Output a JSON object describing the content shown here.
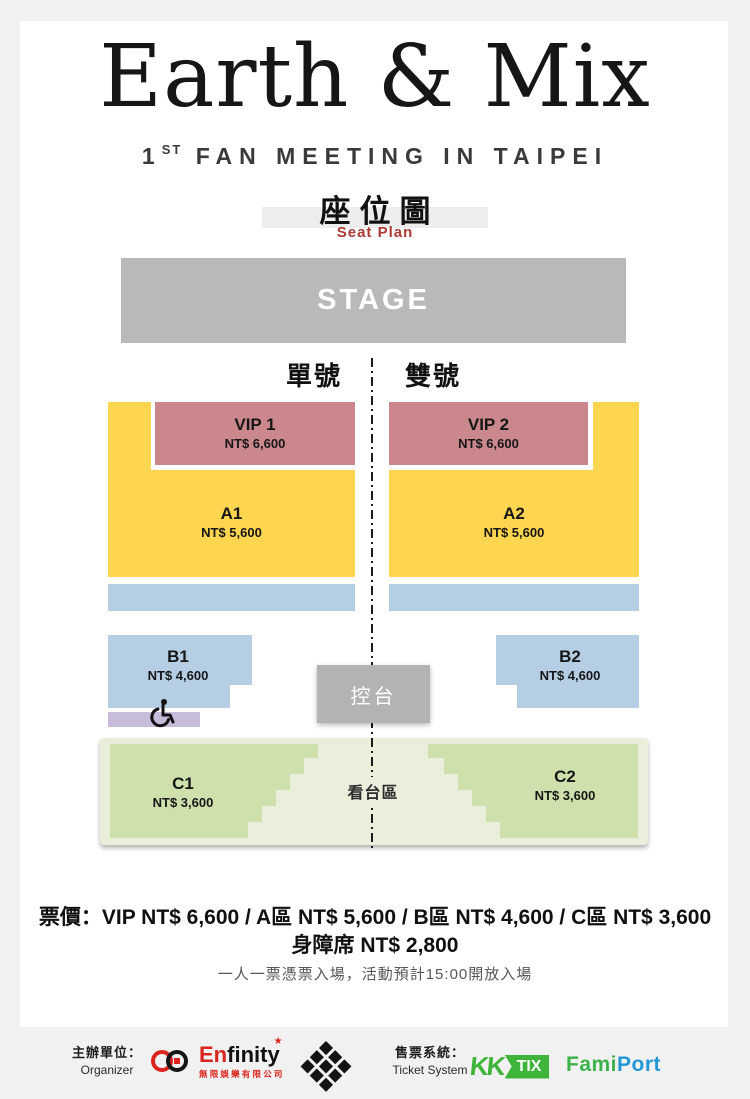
{
  "header": {
    "title": "Earth & Mix",
    "subtitle_number": "1",
    "subtitle_ordinal": "ST",
    "subtitle_text": "FAN MEETING IN TAIPEI",
    "seat_plan_zh": "座位圖",
    "seat_plan_en": "Seat Plan"
  },
  "seat_map": {
    "stage_label": "STAGE",
    "odd_side_label": "單號",
    "even_side_label": "雙號",
    "control_booth_label": "控台",
    "stand_area_label": "看台區",
    "sections": {
      "vip1": {
        "name": "VIP 1",
        "price": "NT$ 6,600",
        "color": "#ca878c"
      },
      "vip2": {
        "name": "VIP 2",
        "price": "NT$ 6,600",
        "color": "#ca878c"
      },
      "a1": {
        "name": "A1",
        "price": "NT$ 5,600",
        "color": "#fdd54e"
      },
      "a2": {
        "name": "A2",
        "price": "NT$ 5,600",
        "color": "#fdd54e"
      },
      "b1": {
        "name": "B1",
        "price": "NT$ 4,600",
        "color": "#b6cee4"
      },
      "b2": {
        "name": "B2",
        "price": "NT$ 4,600",
        "color": "#b6cee4"
      },
      "c1": {
        "name": "C1",
        "price": "NT$ 3,600",
        "color": "#cfe0ac"
      },
      "c2": {
        "name": "C2",
        "price": "NT$ 3,600",
        "color": "#cfe0ac"
      }
    },
    "accessible_row_color": "#c8bcdb",
    "stage_color": "#b9b9b9",
    "stand_area_color": "#e9efdb"
  },
  "pricing": {
    "summary": "票價：VIP NT$ 6,600 / A區 NT$ 5,600 / B區 NT$ 4,600 / C區 NT$ 3,600",
    "accessible": "身障席 NT$ 2,800",
    "admission_note": "一人一票憑票入場，活動預計15:00開放入場"
  },
  "footer": {
    "organizer_label_zh": "主辦單位：",
    "organizer_label_en": "Organizer",
    "ticket_system_label_zh": "售票系統：",
    "ticket_system_label_en": "Ticket System",
    "enfinity": {
      "name_prefix": "En",
      "name_suffix": "finity",
      "star": "★",
      "company_zh": "無限娛樂有限公司"
    },
    "kktix": {
      "kk": "KK",
      "tix": "TIX"
    },
    "famiport": {
      "green": "Fami",
      "blue": "Port"
    }
  }
}
